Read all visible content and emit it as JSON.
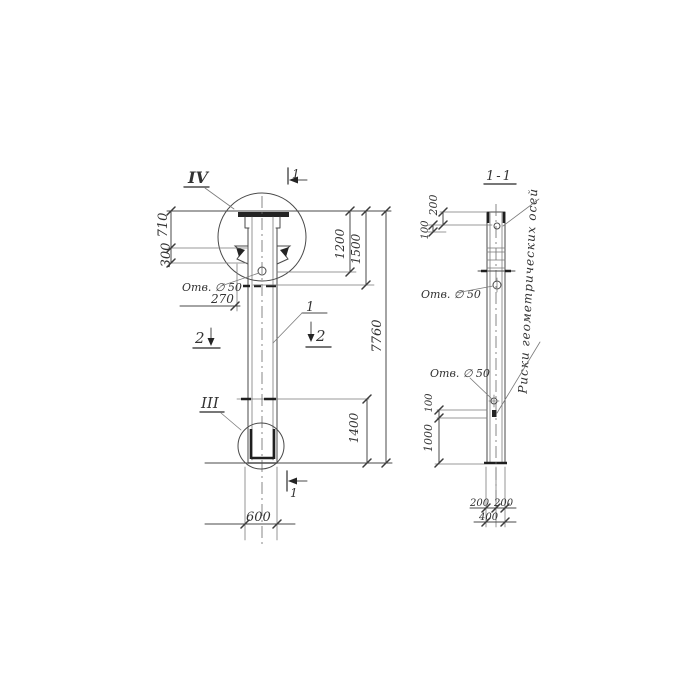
{
  "style": {
    "ink": "#4a4a4a",
    "paper": "#ffffff"
  },
  "drawing": {
    "left_view": {
      "detail_iv": "IV",
      "detail_iii": "III",
      "section_1_top": "1",
      "section_1_bottom": "1",
      "section_2_left": "2",
      "section_2_right": "2",
      "callout_1": "1",
      "hole_label": "Отв. ∅ 50",
      "dim_710": "710",
      "dim_300": "300",
      "dim_270": "270",
      "dim_1200": "1200",
      "dim_1500": "1500",
      "dim_7760": "7760",
      "dim_1400": "1400",
      "dim_600": "600"
    },
    "section_view": {
      "title": "1-1",
      "hole_label_upper": "Отв. ∅ 50",
      "hole_label_lower": "Отв. ∅ 50",
      "axes_note": "Риски геометрических осей",
      "dim_200_top": "200",
      "dim_100_top": "100",
      "dim_100_mid": "100",
      "dim_1000": "1000",
      "dim_200_bottom_left": "200",
      "dim_200_bottom_right": "200",
      "dim_400": "400"
    }
  }
}
